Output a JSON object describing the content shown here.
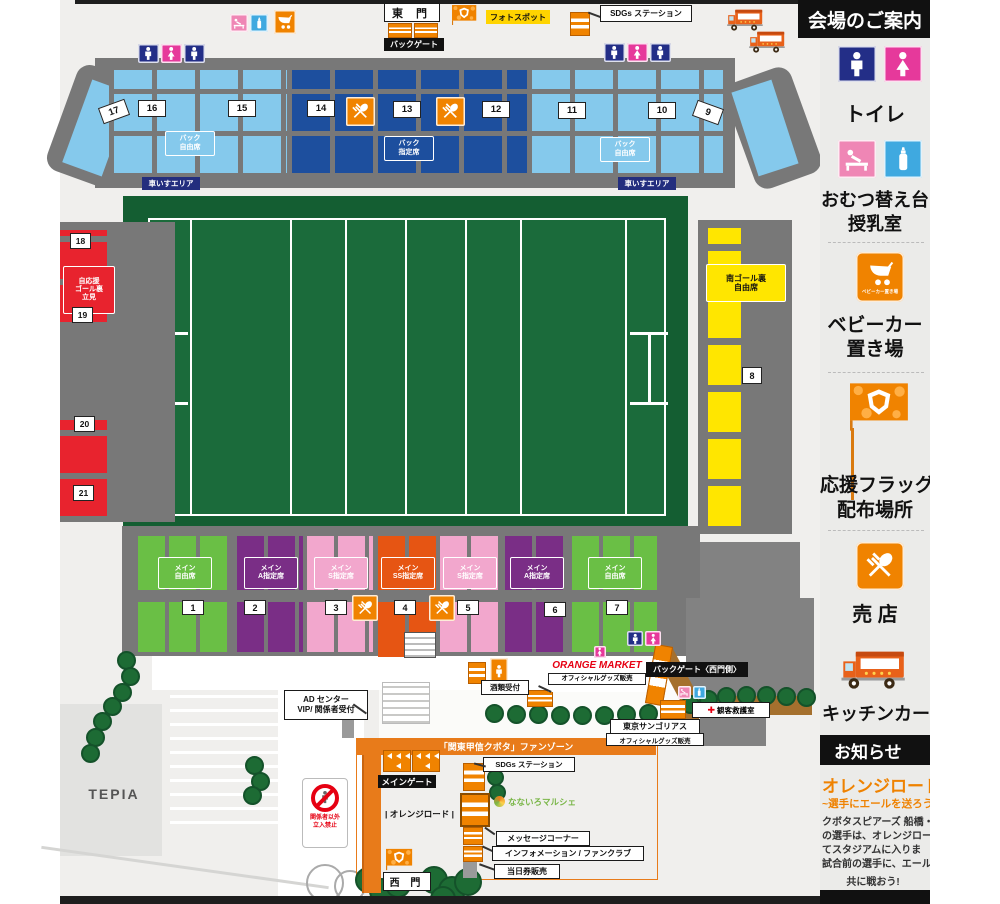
{
  "colors": {
    "accent_orange": "#f08300",
    "fanzone_orange": "#e87b1a",
    "seat_lightblue": "#85c9ec",
    "seat_darkblue": "#1d4f9e",
    "seat_green": "#6abf45",
    "seat_purple": "#7a2e86",
    "seat_pink": "#f2a7cd",
    "seat_ss_orange": "#e65513",
    "seat_red": "#e8232e",
    "seat_yellow": "#ffe600",
    "field_green": "#145e32",
    "market_red": "#e60012"
  },
  "sidebar": {
    "title": "会場のご案内",
    "toilet_label": "トイレ",
    "diaper_label_1": "おむつ替え台",
    "diaper_label_2": "授乳室",
    "stroller_icon_caption": "ベビーカー置き場",
    "stroller_label_1": "ベビーカー",
    "stroller_label_2": "置き場",
    "flag_label_1": "応援フラッグ",
    "flag_label_2": "配布場所",
    "shop_label": "売 店",
    "kitchen_label": "キッチンカー",
    "notice_header": "お知らせ",
    "notice_title": "オレンジロード",
    "notice_subtitle": "~選手にエールを送ろう~",
    "notice_body": "クボタスピアーズ 船橋・東\nの選手は、オレンジロード\nてスタジアムに入りま\n試合前の選手に、エールを",
    "notice_close": "共に戦おう!"
  },
  "map": {
    "east_gate": "東 門",
    "back_gate_label": "バックゲート",
    "photo_spot": "フォトスポット",
    "sdgs_station_top": "SDGs ステーション",
    "back_free_left": "バック\n自由席",
    "back_reserved": "バック\n指定席",
    "back_free_right": "バック\n自由席",
    "wheelchair_left": "車いすエリア",
    "wheelchair_right": "車いすエリア",
    "left_stand_label": "自応援\nゴール裏\n立見",
    "right_stand_label": "南ゴール裏\n自由席",
    "main_sections": [
      {
        "label": "メイン\n自由席"
      },
      {
        "label": "メイン\nA指定席"
      },
      {
        "label": "メイン\nS指定席"
      },
      {
        "label": "メイン\nSS指定席"
      },
      {
        "label": "メイン\nS指定席"
      },
      {
        "label": "メイン\nA指定席"
      },
      {
        "label": "メイン\n自由席"
      }
    ],
    "gates_back": [
      "17",
      "16",
      "15",
      "14",
      "13",
      "12",
      "11",
      "10",
      "9"
    ],
    "gates_main": [
      "1",
      "2",
      "3",
      "4",
      "5",
      "6",
      "7"
    ],
    "gate_east": [
      "8"
    ],
    "gates_left": [
      "18",
      "19",
      "20",
      "21"
    ],
    "orange_market": "ORANGE MARKET",
    "orange_market_sub": "オフィシャルグッズ販売",
    "backgate_west": "バックゲート〈西門側〉",
    "sake_reception": "酒類受付",
    "first_aid": "観客救護室",
    "sungoliath": "東京サンゴリアス",
    "sungoliath_sub": "オフィシャルグッズ販売",
    "fan_zone": "「関東甲信クボタ」ファンゾーン",
    "sdgs_station_bottom": "SDGs ステーション",
    "ad_center_1": "AD センター",
    "ad_center_2": "VIP/ 関係者受付",
    "main_gate": "メインゲート",
    "orange_road": "| オレンジロード |",
    "nanairo": "なないろマルシェ",
    "message_corner": "メッセージコーナー",
    "information": "インフォメーション / ファンクラブ",
    "day_ticket": "当日券販売",
    "west_gate": "西 門",
    "tepia": "TEPIA",
    "no_entry": "関係者以外\n立入禁止"
  }
}
